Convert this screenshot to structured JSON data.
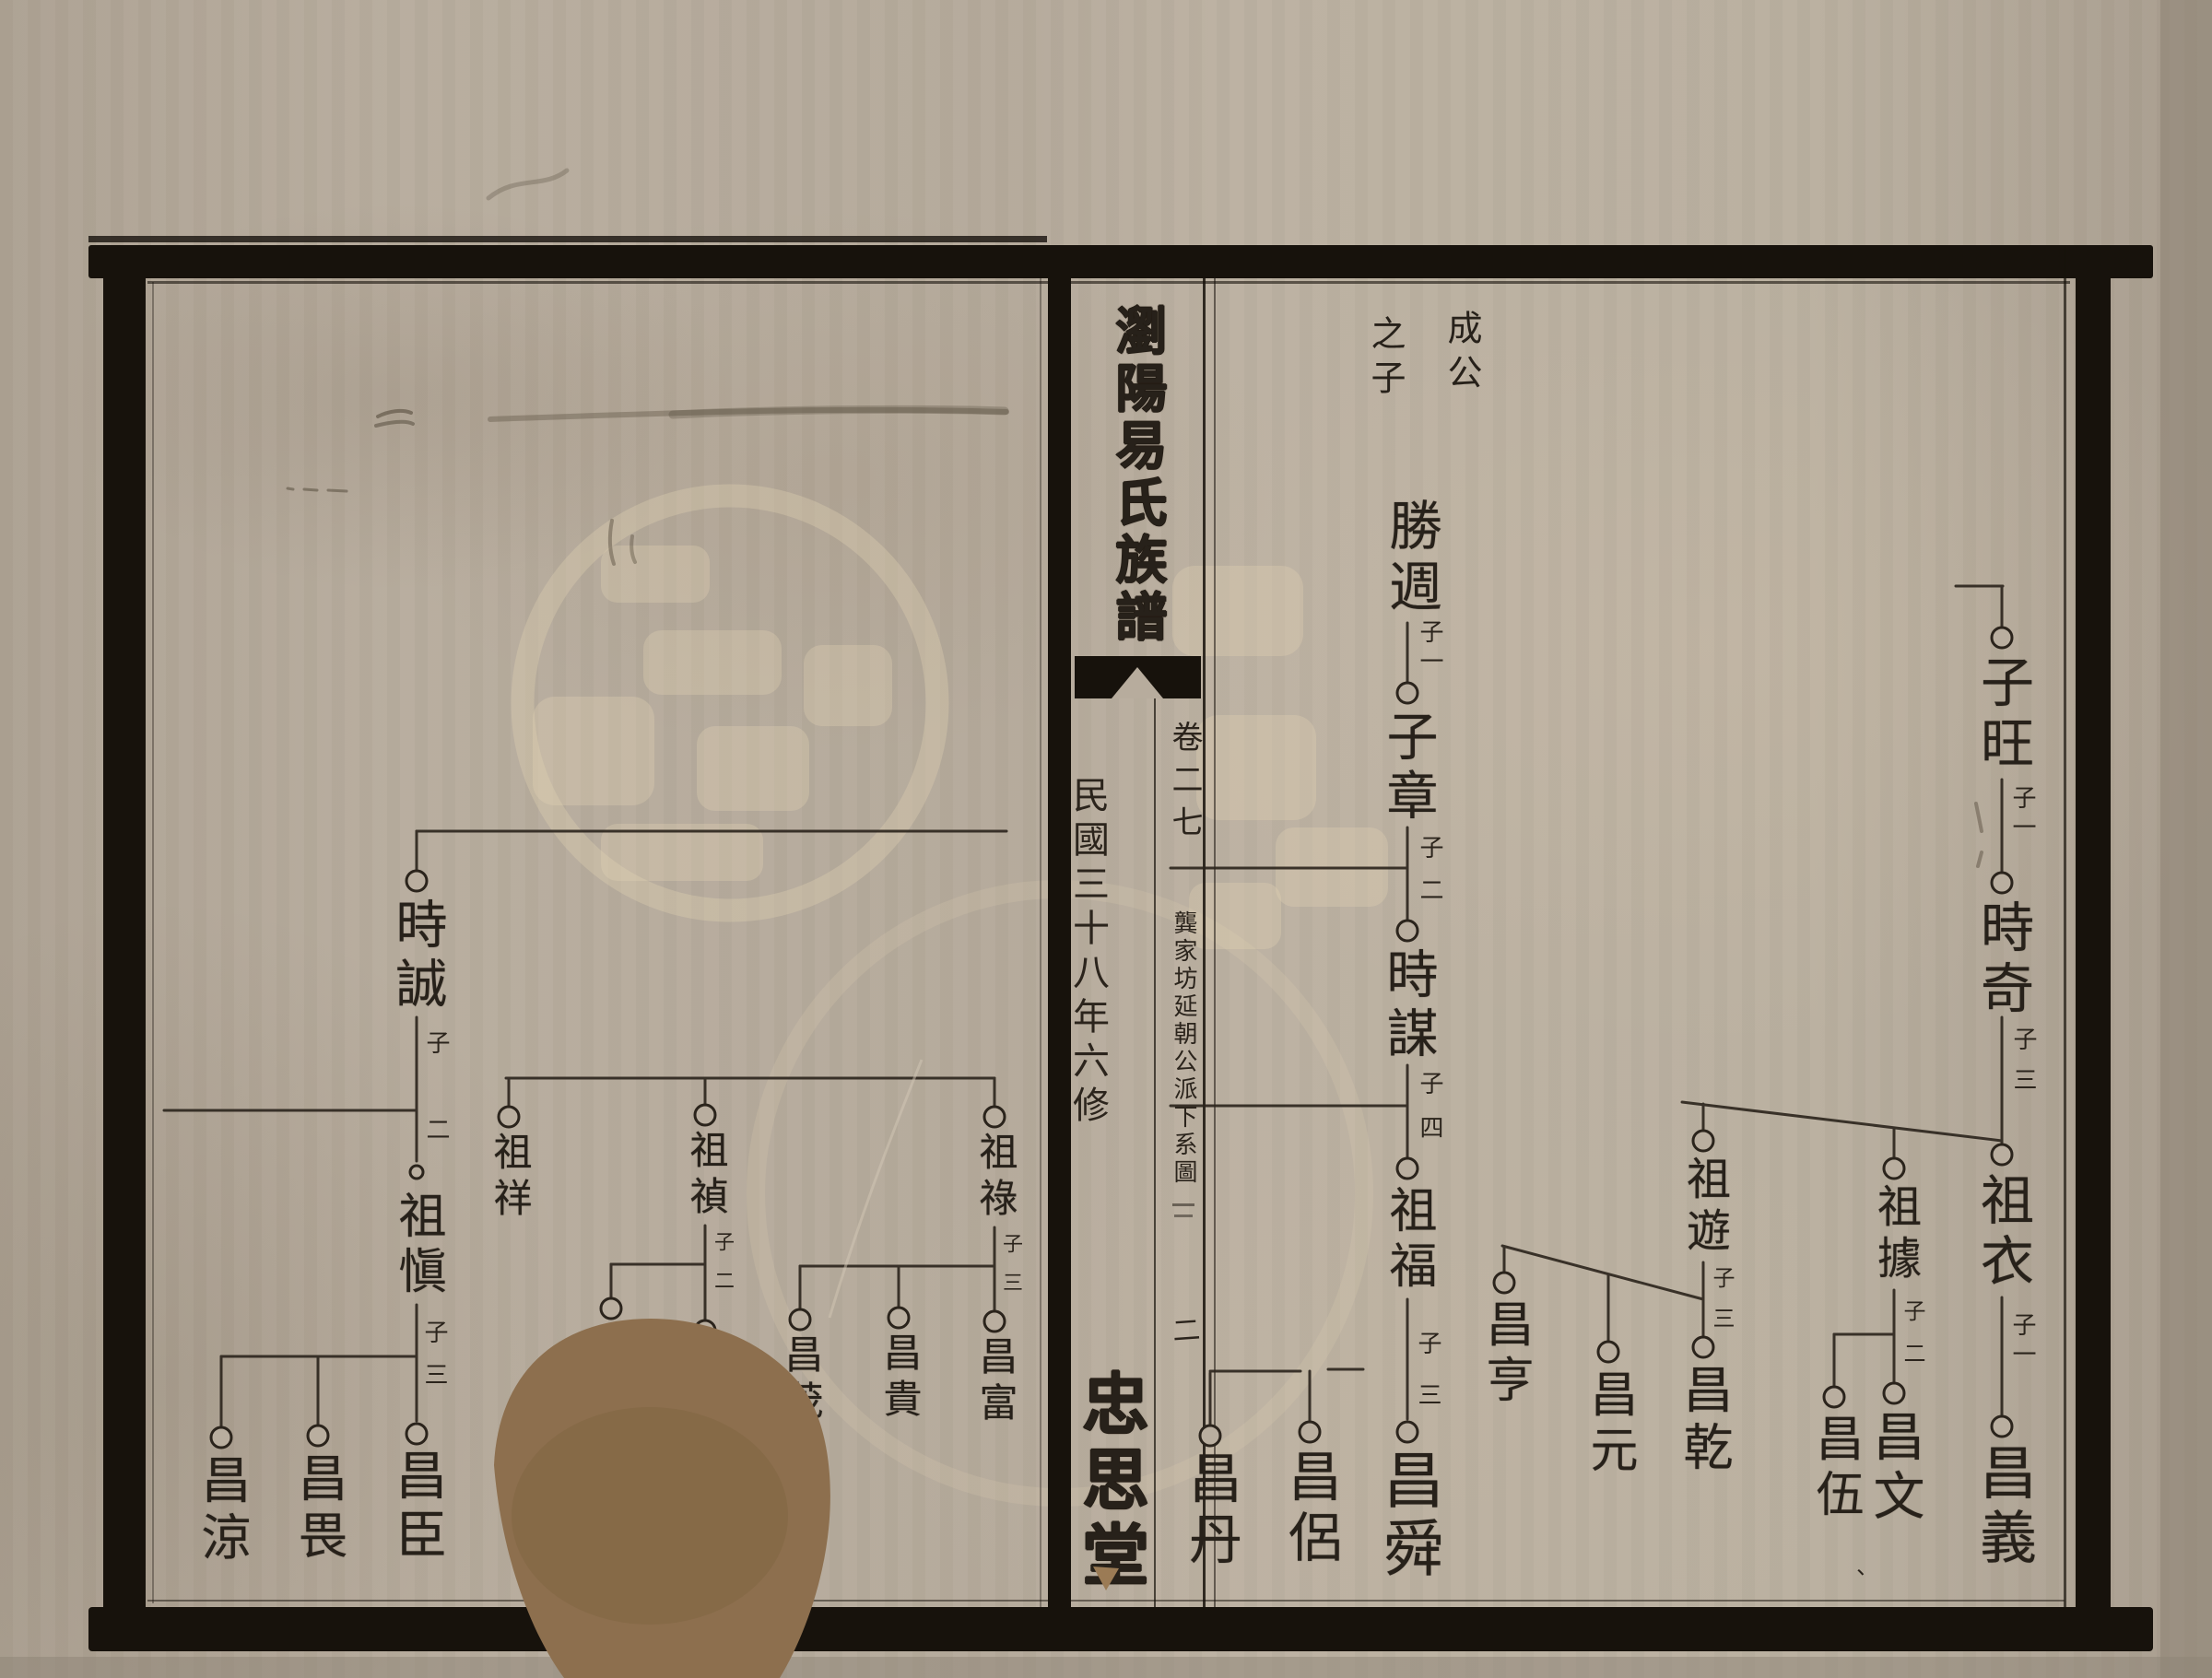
{
  "spine": {
    "title": "瀏陽易氏族譜",
    "volume": "卷二七",
    "series": "龔家坊延朝公派下系圖",
    "edition": "民國三十八年六修",
    "page_number": "二",
    "hall": "忠思堂"
  },
  "right_header": {
    "first": "成公",
    "second": "之子"
  },
  "colors": {
    "ink": "#2b241c",
    "paper": "#b7ac9d",
    "frame": "#17120c",
    "stain": "#8d6f4e",
    "watermark": "#e2d2b4"
  },
  "tree": {
    "people": [
      [
        "勝週",
        1530,
        540,
        58
      ],
      [
        "子章",
        1527,
        770,
        56
      ],
      [
        "時謀",
        1527,
        1028,
        56
      ],
      [
        "祖福",
        1527,
        1286,
        52
      ],
      [
        "昌舜",
        1527,
        1572,
        66
      ],
      [
        "昌侶",
        1421,
        1572,
        58
      ],
      [
        "昌丹",
        1313,
        1574,
        58
      ],
      [
        "子旺",
        2172,
        710,
        58
      ],
      [
        "時奇",
        2172,
        976,
        58
      ],
      [
        "祖衣",
        2172,
        1272,
        58
      ],
      [
        "昌義",
        2172,
        1566,
        62
      ],
      [
        "祖據",
        2055,
        1284,
        48
      ],
      [
        "昌文",
        2055,
        1530,
        56
      ],
      [
        "昌伍",
        1990,
        1534,
        52
      ],
      [
        "祖遊",
        1848,
        1254,
        48
      ],
      [
        "昌乾",
        1848,
        1480,
        54
      ],
      [
        "昌元",
        1745,
        1486,
        52
      ],
      [
        "昌亨",
        1632,
        1410,
        52
      ],
      [
        "時誠",
        452,
        974,
        56
      ],
      [
        "祖愼",
        452,
        1292,
        52
      ],
      [
        "昌臣",
        452,
        1572,
        56
      ],
      [
        "昌畏",
        345,
        1576,
        54
      ],
      [
        "昌涼",
        240,
        1578,
        54
      ],
      [
        "祖祥",
        552,
        1228,
        42
      ],
      [
        "祖禎",
        765,
        1226,
        42
      ],
      [
        "昌",
        765,
        1460,
        42
      ],
      [
        "昌",
        663,
        1436,
        42
      ],
      [
        "祖祿",
        1079,
        1228,
        42
      ],
      [
        "昌富",
        1079,
        1450,
        42
      ],
      [
        "昌貴",
        975,
        1446,
        42
      ],
      [
        "昌茂",
        868,
        1448,
        42
      ]
    ],
    "son_labels": [
      [
        "子一",
        1551,
        672,
        26
      ],
      [
        "子",
        1551,
        906,
        26
      ],
      [
        "二",
        1551,
        952,
        26
      ],
      [
        "子",
        1551,
        1162,
        26
      ],
      [
        "四",
        1551,
        1210,
        26
      ],
      [
        "子",
        1549,
        1444,
        26
      ],
      [
        "三",
        1549,
        1500,
        26
      ],
      [
        "子一",
        2194,
        852,
        26
      ],
      [
        "子",
        2195,
        1114,
        26
      ],
      [
        "三",
        2195,
        1158,
        26
      ],
      [
        "子一",
        2194,
        1424,
        26
      ],
      [
        "子",
        2074,
        1410,
        24
      ],
      [
        "二",
        2074,
        1456,
        24
      ],
      [
        "子",
        1867,
        1374,
        24
      ],
      [
        "三",
        1867,
        1418,
        24
      ],
      [
        "子",
        473,
        1118,
        26
      ],
      [
        "二",
        473,
        1212,
        26
      ],
      [
        "子",
        471,
        1432,
        26
      ],
      [
        "三",
        471,
        1478,
        26
      ],
      [
        "子",
        784,
        1336,
        22
      ],
      [
        "二",
        784,
        1378,
        22
      ],
      [
        "子",
        1097,
        1338,
        22
      ],
      [
        "三",
        1097,
        1380,
        22
      ]
    ],
    "punct": [
      [
        "、",
        2008,
        1702,
        24
      ]
    ],
    "hlines": [
      [
        902,
        452,
        1092
      ],
      [
        1205,
        178,
        452
      ],
      [
        1472,
        240,
        452
      ],
      [
        1170,
        549,
        1079
      ],
      [
        1372,
        663,
        765
      ],
      [
        1374,
        868,
        1079
      ],
      [
        942,
        1270,
        1527
      ],
      [
        1200,
        1270,
        1527
      ],
      [
        1488,
        1313,
        1411
      ],
      [
        1486,
        1441,
        1479
      ],
      [
        1448,
        1990,
        2055
      ],
      [
        636,
        2122,
        2173
      ]
    ],
    "vlines": [
      [
        1527,
        676,
        740
      ],
      [
        1527,
        898,
        998
      ],
      [
        1527,
        1156,
        1256
      ],
      [
        1527,
        1410,
        1540
      ],
      [
        2172,
        636,
        680
      ],
      [
        2172,
        846,
        946
      ],
      [
        2172,
        1104,
        1242
      ],
      [
        2172,
        1408,
        1536
      ],
      [
        2055,
        1224,
        1256
      ],
      [
        2055,
        1400,
        1500
      ],
      [
        1990,
        1448,
        1504
      ],
      [
        1848,
        1198,
        1226
      ],
      [
        1848,
        1370,
        1450
      ],
      [
        1745,
        1383,
        1455
      ],
      [
        1632,
        1354,
        1380
      ],
      [
        1421,
        1488,
        1542
      ],
      [
        1313,
        1490,
        1546
      ],
      [
        452,
        902,
        944
      ],
      [
        452,
        1104,
        1260
      ],
      [
        452,
        1416,
        1542
      ],
      [
        345,
        1472,
        1546
      ],
      [
        240,
        1472,
        1548
      ],
      [
        552,
        1170,
        1200
      ],
      [
        765,
        1170,
        1198
      ],
      [
        765,
        1330,
        1432
      ],
      [
        663,
        1372,
        1408
      ],
      [
        1079,
        1170,
        1200
      ],
      [
        1079,
        1332,
        1422
      ],
      [
        975,
        1374,
        1418
      ],
      [
        868,
        1374,
        1420
      ]
    ],
    "slines": [
      [
        1825,
        1196,
        2172,
        1238
      ],
      [
        1630,
        1352,
        1848,
        1410
      ]
    ],
    "circles": [
      [
        1527,
        752
      ],
      [
        1527,
        1010
      ],
      [
        1527,
        1268
      ],
      [
        1527,
        1554
      ],
      [
        1421,
        1554
      ],
      [
        1313,
        1558
      ],
      [
        2172,
        692
      ],
      [
        2172,
        958
      ],
      [
        2172,
        1253
      ],
      [
        2172,
        1548
      ],
      [
        2055,
        1268
      ],
      [
        2055,
        1512
      ],
      [
        1990,
        1516
      ],
      [
        1848,
        1238
      ],
      [
        1848,
        1462
      ],
      [
        1745,
        1467
      ],
      [
        1632,
        1392
      ],
      [
        452,
        956
      ],
      [
        452,
        1272,
        7
      ],
      [
        452,
        1556
      ],
      [
        345,
        1558
      ],
      [
        240,
        1560
      ],
      [
        552,
        1212
      ],
      [
        765,
        1210
      ],
      [
        765,
        1444
      ],
      [
        663,
        1420
      ],
      [
        1079,
        1212
      ],
      [
        1079,
        1434
      ],
      [
        975,
        1430
      ],
      [
        868,
        1432
      ]
    ]
  }
}
